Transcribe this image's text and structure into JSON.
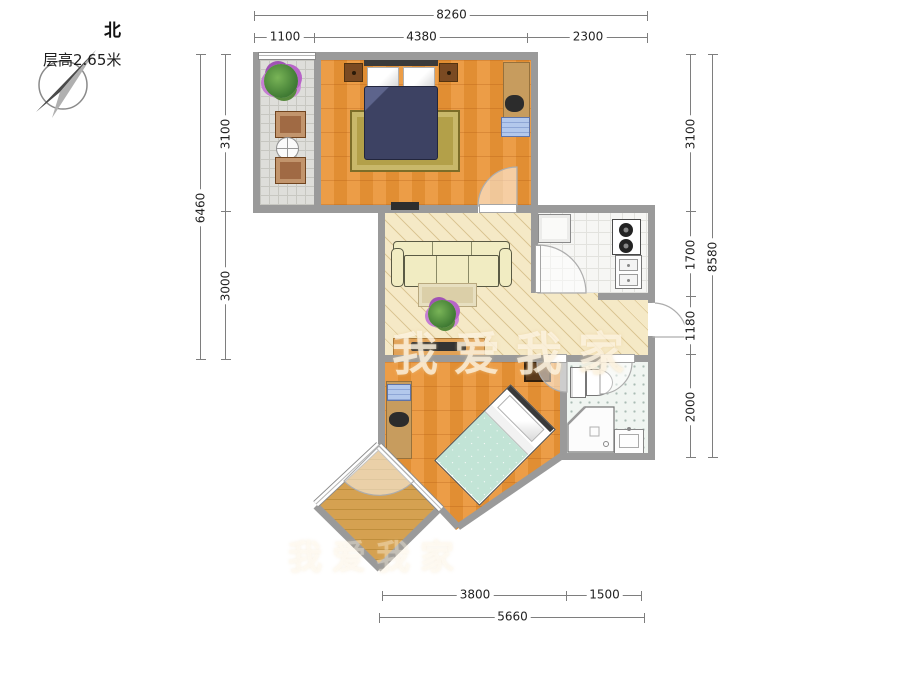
{
  "compass": {
    "north_label": "北"
  },
  "header": {
    "floor_height_label": "层高2.65米"
  },
  "watermark": {
    "text": "我爱我家"
  },
  "dimensions": {
    "top": {
      "total": "8260",
      "segments": [
        "1100",
        "4380",
        "2300"
      ]
    },
    "left": {
      "total": "6460",
      "segments": [
        "3100",
        "3000"
      ]
    },
    "right": {
      "total": "8580",
      "segments": [
        "3100",
        "1700",
        "1180",
        "2000"
      ]
    },
    "bottom": {
      "total": "5660",
      "segments": [
        "3800",
        "1500"
      ]
    }
  },
  "colors": {
    "wall": "#9a9a9a",
    "wood_floor": "#e79440",
    "hall_floor": "#f5e9c6",
    "kitchen_floor": "#f6f6f4",
    "bath_floor": "#f0f5f1",
    "north_balcony_floor": "#dededa",
    "south_balcony_floor": "#d5a151",
    "bed1_duvet": "#3d4263",
    "bed2_duvet": "#c2e4d6",
    "sofa": "#f1ecc2",
    "dimension_text": "#222222"
  }
}
